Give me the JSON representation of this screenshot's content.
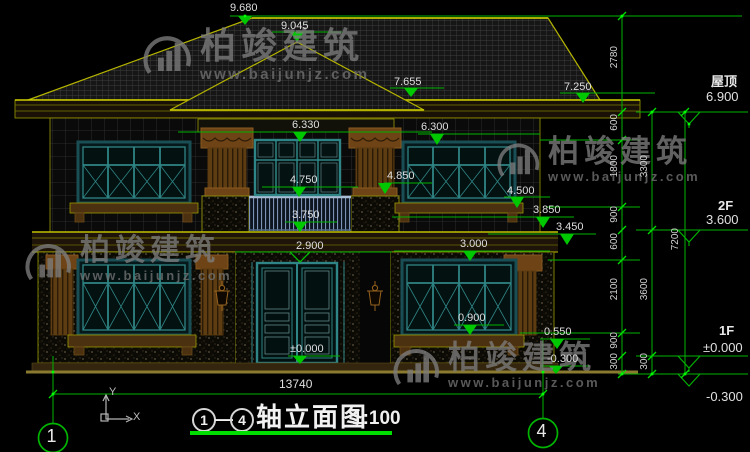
{
  "drawing_title": {
    "axis_from": "1",
    "axis_to": "4",
    "dash": "—",
    "name": "轴立面图",
    "scale": "1:100"
  },
  "axis_bubbles": {
    "left": "1",
    "right": "4"
  },
  "marks": [
    "9.680",
    "9.045",
    "7.655",
    "7.250",
    "6.330",
    "6.300",
    "4.850",
    "4.750",
    "4.500",
    "3.850",
    "3.750",
    "3.450",
    "2.900",
    "3.000",
    "0.900",
    "0.550",
    "±0.000",
    "-0.300"
  ],
  "width_dim": "13740",
  "levels": [
    {
      "label": "屋顶",
      "value": "6.900"
    },
    {
      "label": "2F",
      "value": "3.600"
    },
    {
      "label": "1F",
      "value": "±0.000"
    },
    {
      "label": "",
      "value": "-0.300"
    }
  ],
  "chains": {
    "c1": [
      "2780",
      "600",
      "1800",
      "900",
      "600",
      "2100",
      "900",
      "300"
    ],
    "c2": [
      "3300",
      "3600",
      "300"
    ],
    "c3": [
      "7200"
    ]
  },
  "ucs": {
    "x": "X",
    "y": "Y"
  },
  "watermark": {
    "brand": "柏竣建筑",
    "url": "www.baijunjz.com"
  },
  "colors": {
    "background": "#000000",
    "dim_green": "#00b400",
    "bright_green": "#00dd00",
    "outline_yellow": "#b4b400",
    "frame_teal": "#2f8585",
    "wood_brown": "#6e4315",
    "text_white": "#dfdfdf",
    "watermark_gray": "#7d7d7d"
  }
}
